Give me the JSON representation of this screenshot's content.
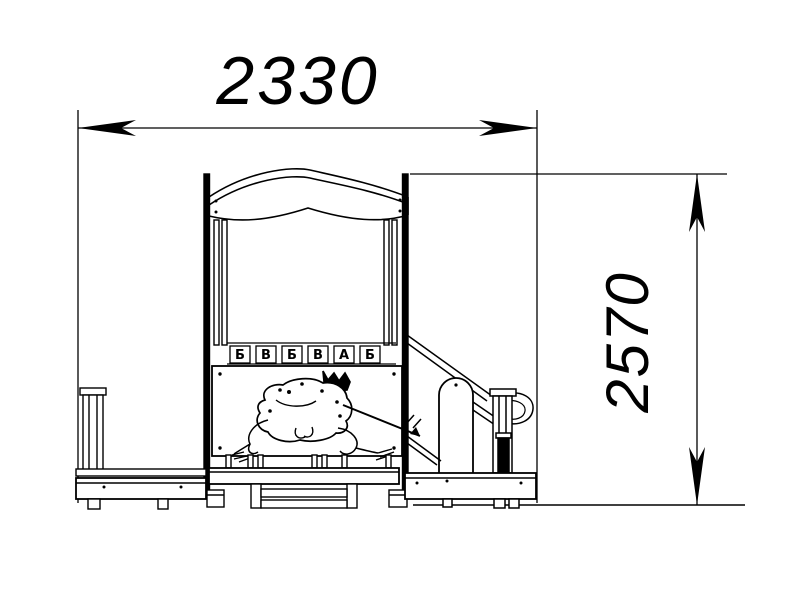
{
  "drawing": {
    "type": "technical-elevation",
    "subject": "children's playground tower with slide, front view",
    "background": "#ffffff",
    "line_color": "#000000",
    "dimensions": {
      "width_mm": "2330",
      "height_mm": "2570"
    },
    "abacus": {
      "letters": [
        "Б",
        "В",
        "Б",
        "В",
        "А",
        "Б"
      ]
    },
    "panel": {
      "art": "frog princess with crown holding an arrow"
    }
  }
}
